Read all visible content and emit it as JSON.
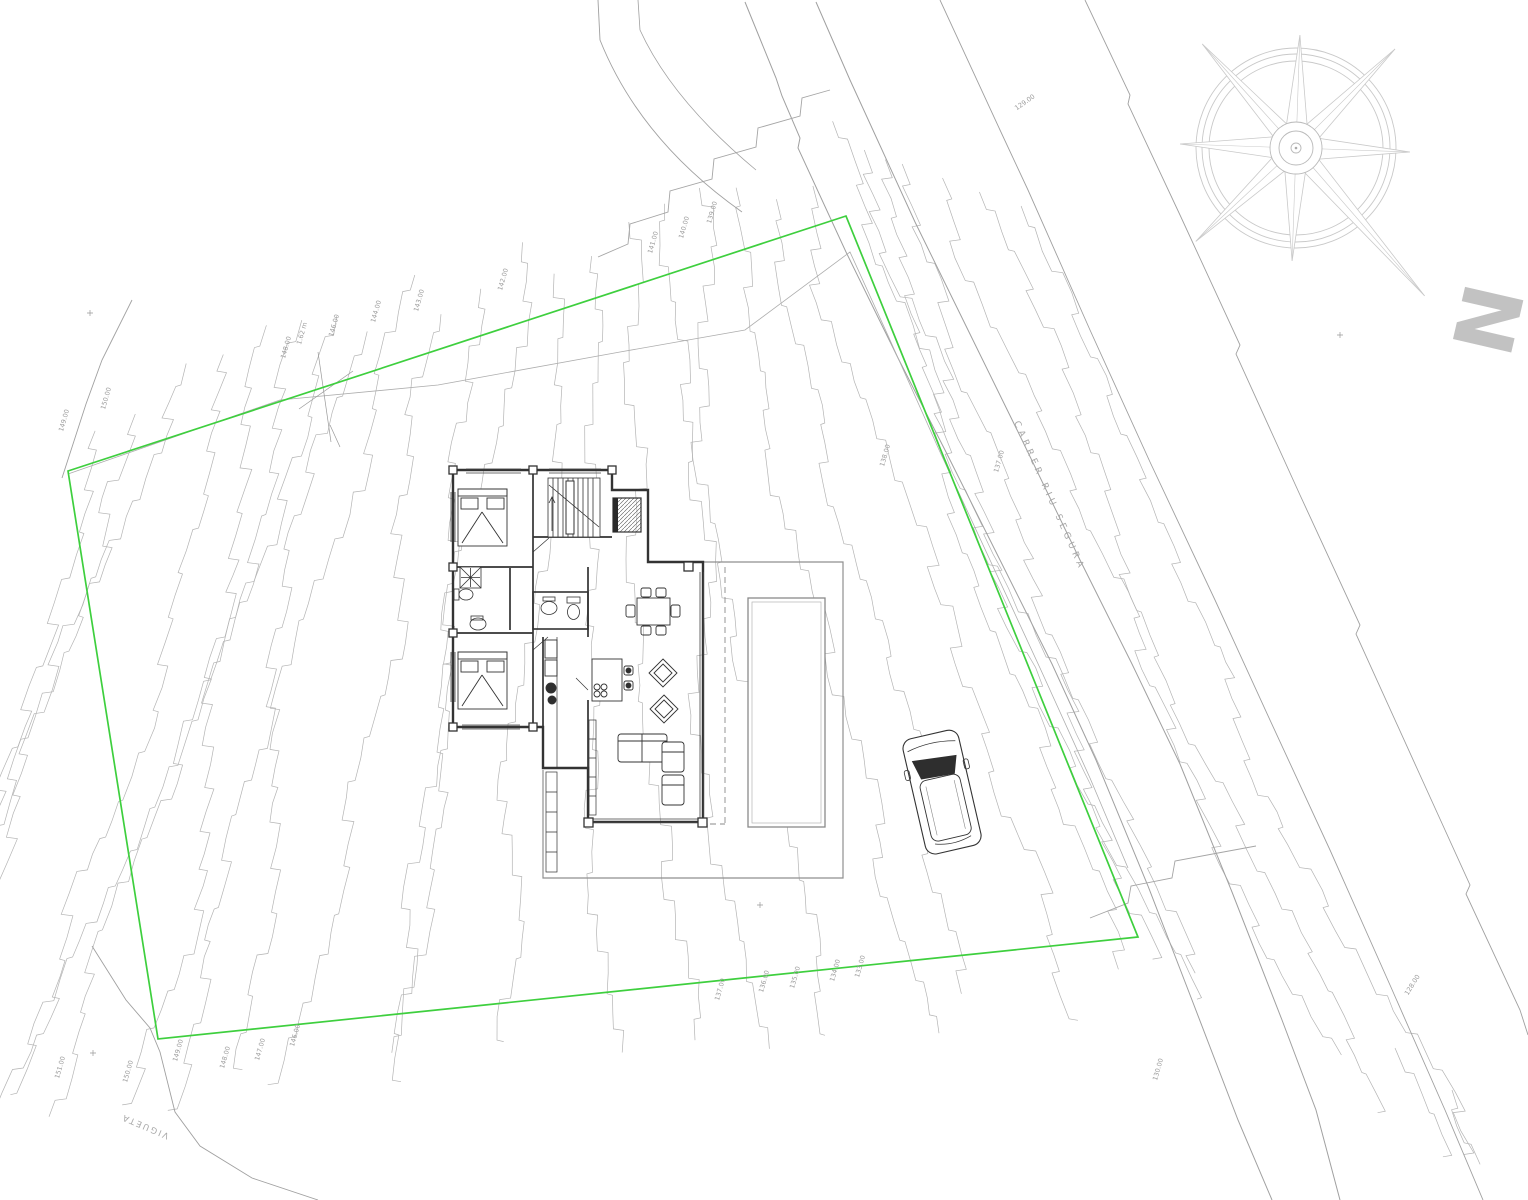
{
  "colors": {
    "boundary_green": "#3ecf3e",
    "contour_gray": "#b4b4b4",
    "parcel_gray": "#a0a0a0",
    "wall_black": "#333333",
    "label_gray": "#9b9b9b",
    "compass_gray": "#c9c9c9",
    "north_letter_gray": "#c2c2c2"
  },
  "boundary": {
    "points": [
      [
        68,
        471
      ],
      [
        846,
        216
      ],
      [
        1138,
        937
      ],
      [
        158,
        1039
      ]
    ]
  },
  "road": {
    "name_label": {
      "text": "CARRER RIU SEGURA",
      "x": 1047,
      "y": 497,
      "rot": 66,
      "size": 9,
      "spacing": 4
    }
  },
  "street_label": {
    "text": "VIGUETA",
    "x": 146,
    "y": 1124,
    "rot": 203,
    "size": 8.5,
    "spacing": 2
  },
  "north": {
    "letter": "N",
    "x": 1459,
    "y": 313,
    "rot": 103,
    "size": 82
  },
  "elevation_labels": [
    {
      "text": "149.00",
      "x": 66,
      "y": 421,
      "rot": -74
    },
    {
      "text": "150.00",
      "x": 108,
      "y": 399,
      "rot": -74
    },
    {
      "text": "148.00",
      "x": 288,
      "y": 348,
      "rot": -74
    },
    {
      "text": "1.62 m",
      "x": 304,
      "y": 334,
      "rot": -74
    },
    {
      "text": "146.00",
      "x": 336,
      "y": 326,
      "rot": -74
    },
    {
      "text": "144.00",
      "x": 378,
      "y": 312,
      "rot": -74
    },
    {
      "text": "143.00",
      "x": 421,
      "y": 301,
      "rot": -74
    },
    {
      "text": "142.00",
      "x": 505,
      "y": 280,
      "rot": -74
    },
    {
      "text": "141.00",
      "x": 655,
      "y": 243,
      "rot": -74
    },
    {
      "text": "140.00",
      "x": 686,
      "y": 228,
      "rot": -74
    },
    {
      "text": "139.00",
      "x": 714,
      "y": 213,
      "rot": -74
    },
    {
      "text": "138.00",
      "x": 887,
      "y": 456,
      "rot": -74
    },
    {
      "text": "137.00",
      "x": 1001,
      "y": 462,
      "rot": -74
    },
    {
      "text": "129.00",
      "x": 1026,
      "y": 104,
      "rot": -35
    },
    {
      "text": "151.00",
      "x": 62,
      "y": 1068,
      "rot": -74
    },
    {
      "text": "150.00",
      "x": 130,
      "y": 1072,
      "rot": -74
    },
    {
      "text": "149.00",
      "x": 180,
      "y": 1051,
      "rot": -74
    },
    {
      "text": "148.00",
      "x": 227,
      "y": 1058,
      "rot": -74
    },
    {
      "text": "147.00",
      "x": 262,
      "y": 1050,
      "rot": -74
    },
    {
      "text": "146.00",
      "x": 297,
      "y": 1036,
      "rot": -74
    },
    {
      "text": "137.00",
      "x": 722,
      "y": 990,
      "rot": -74
    },
    {
      "text": "136.00",
      "x": 766,
      "y": 982,
      "rot": -74
    },
    {
      "text": "135.00",
      "x": 797,
      "y": 978,
      "rot": -74
    },
    {
      "text": "134.00",
      "x": 837,
      "y": 971,
      "rot": -74
    },
    {
      "text": "133.00",
      "x": 862,
      "y": 967,
      "rot": -74
    },
    {
      "text": "130.00",
      "x": 1160,
      "y": 1070,
      "rot": -74
    },
    {
      "text": "128.00",
      "x": 1414,
      "y": 986,
      "rot": -58
    }
  ],
  "terrain": {
    "left_fan_count": 22,
    "right_band_count": 5,
    "seed": 7
  },
  "compass": {
    "cx": 1296,
    "cy": 148,
    "circle_radii": [
      100,
      94,
      87
    ],
    "hub_radii": [
      26,
      17,
      5
    ],
    "arms": [
      {
        "angle": 2,
        "len": 113,
        "hw": 13
      },
      {
        "angle": 45,
        "len": 140,
        "hw": 11
      },
      {
        "angle": 92,
        "len": 114,
        "hw": 13
      },
      {
        "angle": 139,
        "len": 196,
        "hw": 11
      },
      {
        "angle": 182,
        "len": 113,
        "hw": 13
      },
      {
        "angle": 227,
        "len": 137,
        "hw": 11
      },
      {
        "angle": 272,
        "len": 116,
        "hw": 13
      },
      {
        "angle": 318,
        "len": 140,
        "hw": 11
      }
    ]
  }
}
